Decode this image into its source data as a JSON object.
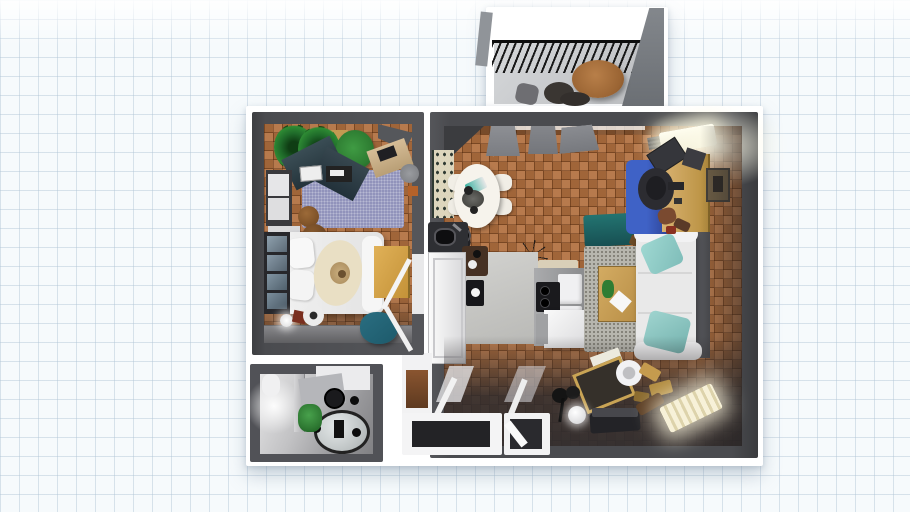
{
  "scene": {
    "type": "3d-floor-plan-top-down-render",
    "description": "Top-down 3D render of a one-bedroom apartment floor plan placed on a light grid-paper canvas"
  },
  "colors": {
    "canvas_bg": "#f6fafc",
    "grid_line": "#c7d5e2",
    "sheet": "#ffffff",
    "wall": "#4a4b4f",
    "wall_light": "#797d82",
    "parquet": "#b2703f",
    "rug_purple": "#9193bb",
    "rug_gray": "#b7b6ae",
    "rug_blue": "#3f62c6",
    "teal_bench": "#237471",
    "teal_pillow": "#9fd8d2",
    "teal_pouf": "#2a6e81",
    "wood_tan": "#cfa964",
    "bed_white": "#e9e9e9",
    "blanket_cream": "#e9dfc4",
    "plant_green": "#2e7d32",
    "balcony_floor": "#c9cbcd",
    "ottoman_brown": "#a9713d",
    "bath_light": "#dededf",
    "dark_floor_shadow": "#2e2c2e",
    "glow_warm": "#fff8dd"
  },
  "rooms": [
    {
      "id": "balcony",
      "label": "Balcony",
      "furniture": [
        "railing",
        "round-ottoman-table",
        "dark-chair",
        "side-chair"
      ]
    },
    {
      "id": "bedroom",
      "label": "Bedroom with office corner",
      "furniture": [
        "palm-plant",
        "palm-plant",
        "bush-plant",
        "tan-shelf",
        "dark-desk",
        "laptop",
        "printer",
        "dresser",
        "white-shelf",
        "wicker-basket",
        "wicker-basket",
        "double-bed",
        "pillows",
        "cream-blanket",
        "nightstand",
        "window",
        "floor-lamp",
        "stool",
        "maroon-box",
        "teal-pouf",
        "corner-desk",
        "corner-stool",
        "open-door"
      ]
    },
    {
      "id": "living-kitchen",
      "label": "Living room with open kitchen and dining",
      "furniture": [
        "curtains",
        "window-radiator",
        "dotted-cabinet",
        "dining-table",
        "dining-chair-x4",
        "exercise-bike",
        "chandelier",
        "kitchen-mat",
        "fridge",
        "sink-counter",
        "coffee-station",
        "black-art-panel",
        "kitchen-counter",
        "stove",
        "upper-cabinets",
        "island",
        "teal-bench",
        "area-rug",
        "coffee-table",
        "plant",
        "sofa",
        "throw-pillow-x2",
        "blue-rug",
        "desk",
        "monitor",
        "office-chair",
        "speaker",
        "wall-art",
        "storage-chest",
        "coat-stand",
        "sphere-lamp",
        "cylinder-lamp",
        "hall-bench",
        "radiator",
        "gold-decor",
        "brown-case"
      ]
    },
    {
      "id": "bathroom",
      "label": "Bathroom",
      "furniture": [
        "partition",
        "toilet",
        "round-mirror",
        "glass-table",
        "black-stool-x3",
        "plant",
        "wall-lamp"
      ]
    },
    {
      "id": "entrance",
      "label": "Entrance doorways",
      "furniture": [
        "door-frame-wide",
        "door-frame-narrow",
        "door-leaf"
      ]
    }
  ]
}
